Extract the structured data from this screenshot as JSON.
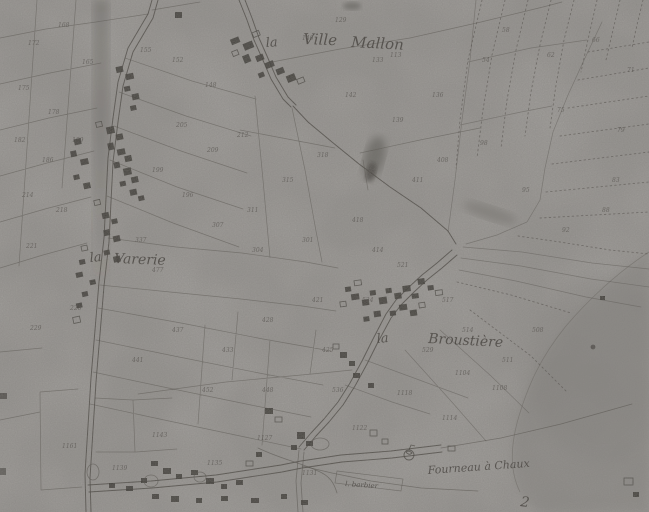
{
  "map": {
    "description": "scanned historical cadastral map sheet",
    "palette": {
      "paper": "#b3b1ad",
      "wash": "#8e8c88",
      "ink": "#3a3731",
      "ink_faint": "#55514b"
    },
    "place_labels": [
      {
        "name": "label-la-ville-mallon-la",
        "text": "la",
        "x": 266,
        "y": 47,
        "size": 13,
        "rotate": -4
      },
      {
        "name": "label-la-ville-mallon-ville",
        "text": "Ville",
        "x": 303,
        "y": 44,
        "size": 15,
        "rotate": 2
      },
      {
        "name": "label-la-ville-mallon-mallon",
        "text": "Mallon",
        "x": 351,
        "y": 47,
        "size": 15,
        "rotate": 3
      },
      {
        "name": "label-la-varerie-la",
        "text": "la",
        "x": 90,
        "y": 262,
        "size": 13,
        "rotate": -5
      },
      {
        "name": "label-la-varerie-varerie",
        "text": "Varerie",
        "x": 114,
        "y": 263,
        "size": 14,
        "rotate": 2
      },
      {
        "name": "label-la-broustiere-la",
        "text": "la",
        "x": 377,
        "y": 343,
        "size": 13,
        "rotate": -5
      },
      {
        "name": "label-la-broustiere-broustiere",
        "text": "Broustière",
        "x": 428,
        "y": 343,
        "size": 14,
        "rotate": 3
      },
      {
        "name": "label-fourneau-a-chaux",
        "text": "Fourneau à Chaux",
        "x": 428,
        "y": 474,
        "size": 11,
        "rotate": -4
      },
      {
        "name": "label-barbier",
        "text": "l. barbier",
        "x": 345,
        "y": 486,
        "size": 7,
        "rotate": 4
      },
      {
        "name": "label-numeral-2",
        "text": "2",
        "x": 520,
        "y": 506,
        "size": 14,
        "rotate": 8
      }
    ],
    "parcel_numbers": [
      {
        "t": "172",
        "x": 28,
        "y": 45
      },
      {
        "t": "168",
        "x": 58,
        "y": 27
      },
      {
        "t": "175",
        "x": 18,
        "y": 90
      },
      {
        "t": "178",
        "x": 48,
        "y": 114
      },
      {
        "t": "165",
        "x": 82,
        "y": 64
      },
      {
        "t": "182",
        "x": 14,
        "y": 142
      },
      {
        "t": "186",
        "x": 42,
        "y": 162
      },
      {
        "t": "189",
        "x": 72,
        "y": 142
      },
      {
        "t": "214",
        "x": 22,
        "y": 197
      },
      {
        "t": "218",
        "x": 56,
        "y": 212
      },
      {
        "t": "221",
        "x": 26,
        "y": 248
      },
      {
        "t": "226",
        "x": 70,
        "y": 310
      },
      {
        "t": "229",
        "x": 30,
        "y": 330
      },
      {
        "t": "155",
        "x": 140,
        "y": 52
      },
      {
        "t": "152",
        "x": 172,
        "y": 62
      },
      {
        "t": "148",
        "x": 205,
        "y": 87
      },
      {
        "t": "205",
        "x": 176,
        "y": 127
      },
      {
        "t": "209",
        "x": 207,
        "y": 152
      },
      {
        "t": "212",
        "x": 237,
        "y": 137
      },
      {
        "t": "199",
        "x": 152,
        "y": 172
      },
      {
        "t": "196",
        "x": 182,
        "y": 197
      },
      {
        "t": "337",
        "x": 135,
        "y": 242
      },
      {
        "t": "477",
        "x": 152,
        "y": 272
      },
      {
        "t": "307",
        "x": 212,
        "y": 227
      },
      {
        "t": "311",
        "x": 247,
        "y": 212
      },
      {
        "t": "315",
        "x": 282,
        "y": 182
      },
      {
        "t": "318",
        "x": 317,
        "y": 157
      },
      {
        "t": "304",
        "x": 252,
        "y": 252
      },
      {
        "t": "301",
        "x": 302,
        "y": 242
      },
      {
        "t": "142",
        "x": 345,
        "y": 97
      },
      {
        "t": "139",
        "x": 392,
        "y": 122
      },
      {
        "t": "136",
        "x": 432,
        "y": 97
      },
      {
        "t": "133",
        "x": 372,
        "y": 62
      },
      {
        "t": "146",
        "x": 302,
        "y": 40
      },
      {
        "t": "113",
        "x": 390,
        "y": 57
      },
      {
        "t": "129",
        "x": 335,
        "y": 22
      },
      {
        "t": "54",
        "x": 482,
        "y": 62
      },
      {
        "t": "58",
        "x": 502,
        "y": 32
      },
      {
        "t": "62",
        "x": 547,
        "y": 57
      },
      {
        "t": "66",
        "x": 592,
        "y": 42
      },
      {
        "t": "71",
        "x": 627,
        "y": 72
      },
      {
        "t": "75",
        "x": 557,
        "y": 112
      },
      {
        "t": "79",
        "x": 617,
        "y": 132
      },
      {
        "t": "83",
        "x": 612,
        "y": 182
      },
      {
        "t": "88",
        "x": 602,
        "y": 212
      },
      {
        "t": "92",
        "x": 562,
        "y": 232
      },
      {
        "t": "95",
        "x": 522,
        "y": 192
      },
      {
        "t": "98",
        "x": 480,
        "y": 145
      },
      {
        "t": "418",
        "x": 352,
        "y": 222
      },
      {
        "t": "421",
        "x": 312,
        "y": 302
      },
      {
        "t": "428",
        "x": 262,
        "y": 322
      },
      {
        "t": "433",
        "x": 222,
        "y": 352
      },
      {
        "t": "437",
        "x": 172,
        "y": 332
      },
      {
        "t": "441",
        "x": 132,
        "y": 362
      },
      {
        "t": "452",
        "x": 202,
        "y": 392
      },
      {
        "t": "448",
        "x": 262,
        "y": 392
      },
      {
        "t": "425",
        "x": 322,
        "y": 352
      },
      {
        "t": "414",
        "x": 372,
        "y": 252
      },
      {
        "t": "411",
        "x": 412,
        "y": 182
      },
      {
        "t": "408",
        "x": 437,
        "y": 162
      },
      {
        "t": "521",
        "x": 397,
        "y": 267
      },
      {
        "t": "517",
        "x": 442,
        "y": 302
      },
      {
        "t": "524",
        "x": 362,
        "y": 302
      },
      {
        "t": "529",
        "x": 422,
        "y": 352
      },
      {
        "t": "514",
        "x": 462,
        "y": 332
      },
      {
        "t": "511",
        "x": 502,
        "y": 362
      },
      {
        "t": "508",
        "x": 532,
        "y": 332
      },
      {
        "t": "1143",
        "x": 152,
        "y": 437
      },
      {
        "t": "1161",
        "x": 62,
        "y": 448
      },
      {
        "t": "1139",
        "x": 112,
        "y": 470
      },
      {
        "t": "1135",
        "x": 207,
        "y": 465
      },
      {
        "t": "1127",
        "x": 257,
        "y": 440
      },
      {
        "t": "1131",
        "x": 302,
        "y": 475
      },
      {
        "t": "1122",
        "x": 352,
        "y": 430
      },
      {
        "t": "1118",
        "x": 397,
        "y": 395
      },
      {
        "t": "1114",
        "x": 442,
        "y": 420
      },
      {
        "t": "1108",
        "x": 492,
        "y": 390
      },
      {
        "t": "536",
        "x": 332,
        "y": 392
      },
      {
        "t": "1104",
        "x": 455,
        "y": 375
      }
    ]
  }
}
